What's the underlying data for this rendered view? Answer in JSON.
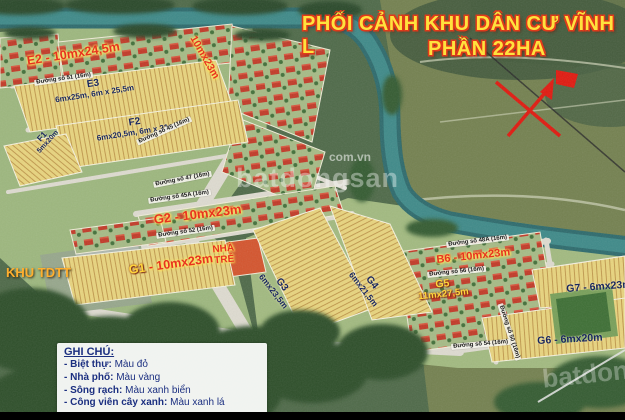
{
  "title": {
    "line1": "PHỐI CẢNH KHU DÂN CƯ VĨNH L",
    "line2": "PHẦN 22HA"
  },
  "watermark": {
    "small": "com.vn",
    "large": "batdongsan",
    "corner": "batdongsan"
  },
  "legend": {
    "heading": "GHI CHÚ:",
    "items": [
      {
        "term": "- Biệt thự:",
        "value": "Màu đỏ"
      },
      {
        "term": "- Nhà phố:",
        "value": "Màu vàng"
      },
      {
        "term": "- Sông rạch:",
        "value": "Màu xanh biển"
      },
      {
        "term": "- Công viên cây xanh:",
        "value": "Màu xanh lá"
      }
    ]
  },
  "areas": {
    "khu_tdtt": "KHU TDTT",
    "nha_tre": "NHÀ TRẺ",
    "e2": "E2 - 10mx24,5m",
    "e4_dim": "10mx23m",
    "e3": {
      "name": "E3",
      "dims": "6mx25m, 6m x 25,5m"
    },
    "f2": {
      "name": "F2",
      "dims": "6mx20,5m, 6m x 21m"
    },
    "f1": {
      "name": "F1",
      "dims": "5mx20m"
    },
    "g1": {
      "name": "G1",
      "dims": "- 10mx23m"
    },
    "g2": "G2 - 10mx23m",
    "g3": {
      "name": "G3",
      "dims": "6mx23,5m"
    },
    "g4": {
      "name": "G4",
      "dims": "6mx21,5m"
    },
    "g5": {
      "name": "G5",
      "dims": "11mx27,5m"
    },
    "g6": "G6 - 6mx20m",
    "g7": "G7 - 6mx23m",
    "b6": "B6 - 10mx23m"
  },
  "streets": {
    "s51": "Đường số 51 (16m)",
    "s45": "Đường số 45 (16m)",
    "s47": "Đường số 47 (16m)",
    "s45a": "Đường số 45A (16m)",
    "s52": "Đường số 52 (16m)",
    "s48a": "Đường số 48A (16m)",
    "s56": "Đường số 56 (16m)",
    "s50": "Đường số 50 (16m)",
    "s54": "Đường số 54 (16m)"
  },
  "colors": {
    "title_yellow": "#ffe23d",
    "title_outline": "#e03a1a",
    "villa_red": "#c23a28",
    "townhouse_yellow": "#e8d47e",
    "river_teal": "#35787a",
    "park_green": "#3e6f35",
    "label_red": "#e8331f",
    "label_navy": "#18265f",
    "label_orange": "#ffaf2e",
    "legend_navy": "#1b2f80"
  }
}
